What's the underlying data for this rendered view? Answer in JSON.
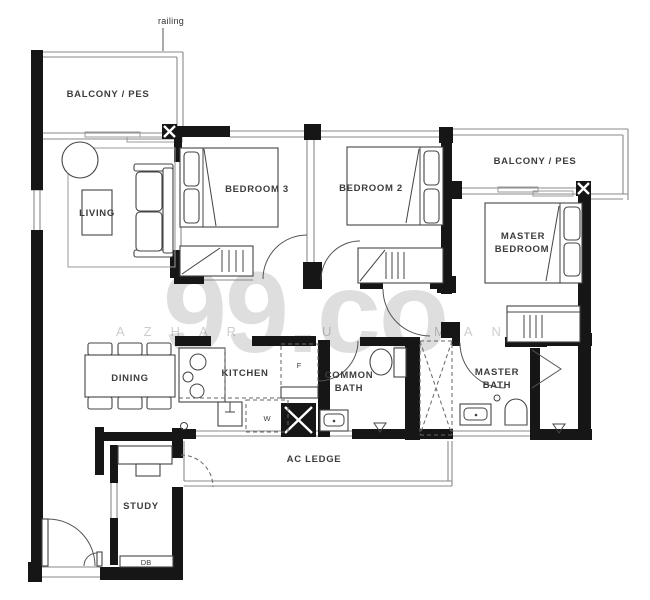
{
  "watermark": {
    "brand": "99.co",
    "letters_left": "AZHAR",
    "letters_mid": "U",
    "letters_right": "MAN"
  },
  "rooms": {
    "balcony_left": {
      "label": "BALCONY / PES"
    },
    "living": {
      "label": "LIVING"
    },
    "bedroom3": {
      "label": "BEDROOM 3"
    },
    "bedroom2": {
      "label": "BEDROOM 2"
    },
    "balcony_right": {
      "label": "BALCONY / PES"
    },
    "master_bedroom": {
      "line1": "MASTER",
      "line2": "BEDROOM"
    },
    "dining": {
      "label": "DINING"
    },
    "kitchen": {
      "label": "KITCHEN"
    },
    "common_bath": {
      "line1": "COMMON",
      "line2": "BATH"
    },
    "master_bath": {
      "line1": "MASTER",
      "line2": "BATH"
    },
    "ac_ledge": {
      "label": "AC LEDGE"
    },
    "study": {
      "label": "STUDY"
    }
  },
  "annotations": {
    "railing": "railing",
    "db": "DB",
    "fridge": "F",
    "washer": "W"
  },
  "colors": {
    "wall": "#161616",
    "thin_line": "#8a8a8a",
    "label_text": "#3c3c3c",
    "watermark": "#d9d9d9",
    "background": "#ffffff"
  }
}
